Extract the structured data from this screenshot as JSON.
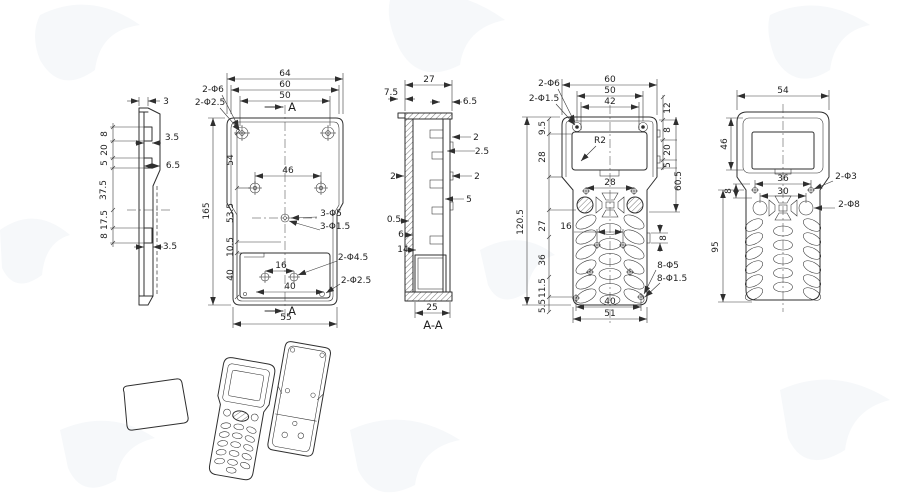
{
  "views": {
    "profile": {
      "top": "3",
      "left": [
        "8",
        "20",
        "5",
        "37.5",
        "17.5",
        "8"
      ],
      "right": [
        "3.5",
        "6.5",
        "3.5"
      ]
    },
    "back": {
      "width_dims": [
        "64",
        "60",
        "50"
      ],
      "holes_top": [
        "2-Φ6",
        "2-Φ2.5"
      ],
      "height": "165",
      "chain": [
        "54",
        "53.5",
        "10.5",
        "40"
      ],
      "boss_span": "46",
      "inner_span": "16",
      "inner_span2": "40",
      "holes_mid": [
        "3-Φ5",
        "3-Φ1.5"
      ],
      "hole_boss": "2-Φ4.5",
      "hole_corner": "2-Φ2.5",
      "bottom": "55",
      "mark": "A"
    },
    "section": {
      "top": "27",
      "lip": "7.5",
      "lip_r": "6.5",
      "right": [
        "2",
        "2.5",
        "2",
        "5"
      ],
      "left": [
        "2",
        "0.5",
        "6",
        "14"
      ],
      "bottom": "25",
      "label": "A-A"
    },
    "front": {
      "width_dims": [
        "60",
        "50",
        "42"
      ],
      "holes_top": [
        "2-Φ6",
        "2-Φ1.5"
      ],
      "left_chain": [
        "9.5",
        "28"
      ],
      "height": "120.5",
      "right_chain": [
        "12",
        "8",
        "20",
        "5"
      ],
      "right_height": "60.5",
      "radius": "R2",
      "key_span": "28",
      "key_pitch": "16",
      "v_chain": [
        "27",
        "36",
        "11.5",
        "5.5"
      ],
      "tab": "8",
      "holes_keys": [
        "8-Φ5",
        "8-Φ1.5"
      ],
      "bottom_dims": [
        "40",
        "51"
      ]
    },
    "outer": {
      "top": "54",
      "screen": "46",
      "key_spans": [
        "36",
        "30"
      ],
      "left": "8",
      "height": "95",
      "holes": [
        "2-Φ3",
        "2-Φ8"
      ]
    }
  }
}
